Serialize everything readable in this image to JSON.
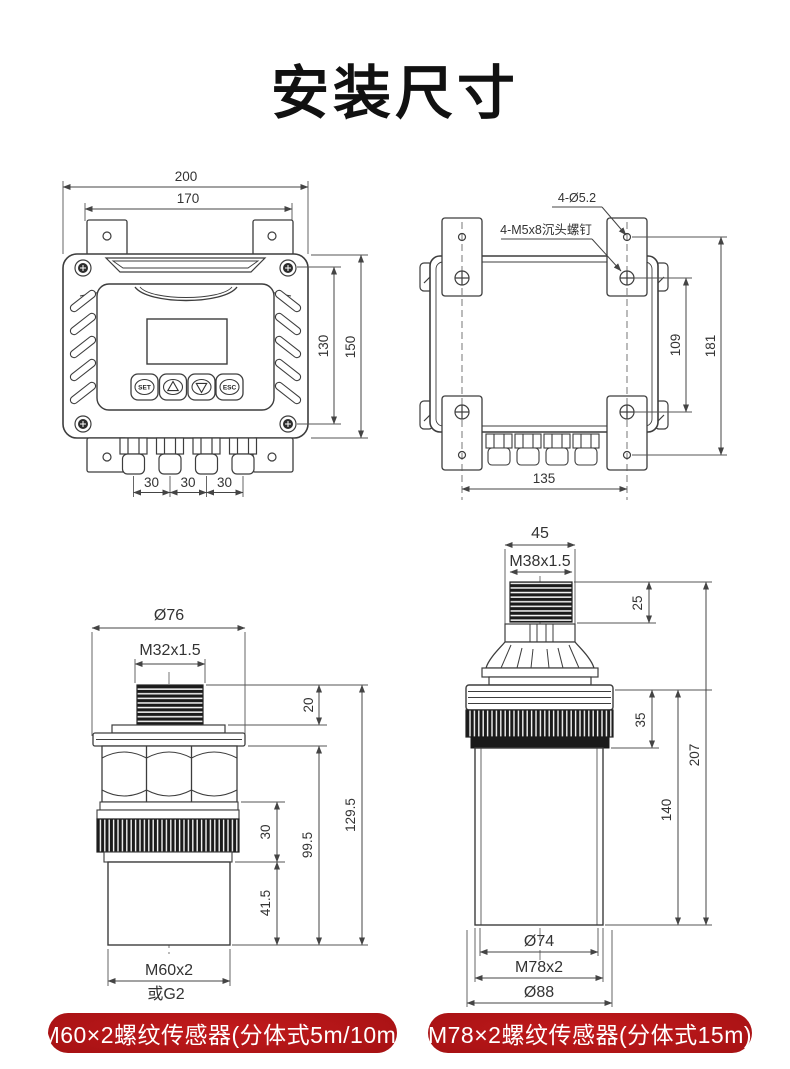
{
  "title": "安装尺寸",
  "line_color": "#444444",
  "accent_red": "#a51113",
  "controller_front": {
    "width_outer": "200",
    "width_tabs": "170",
    "height_inner": "130",
    "height_outer": "150",
    "gland_pitch": [
      "30",
      "30",
      "30"
    ],
    "btn_set": "SET",
    "btn_esc": "ESC"
  },
  "controller_back": {
    "holes_note": "4-Ø5.2",
    "screws_note": "4-M5x8沉头螺钉",
    "height_inner": "109",
    "height_outer": "181",
    "width_holes": "135"
  },
  "sensor_m60": {
    "flange_dia": "Ø76",
    "top_thread": "M32x1.5",
    "h_thread": "20",
    "h_ring": "30",
    "h_lower": "99.5",
    "h_tip": "41.5",
    "h_total": "129.5",
    "bottom_thread": "M60x2",
    "bottom_thread_alt": "或G2"
  },
  "sensor_m78": {
    "top_width": "45",
    "top_thread": "M38x1.5",
    "h_thread": "25",
    "h_ring": "35",
    "h_body": "140",
    "h_total": "207",
    "body_dia": "Ø74",
    "bottom_thread": "M78x2",
    "max_dia": "Ø88"
  },
  "footer": {
    "left_button": "M60×2螺纹传感器(分体式5m/10m)",
    "right_button": "M78×2螺纹传感器(分体式15m)"
  }
}
